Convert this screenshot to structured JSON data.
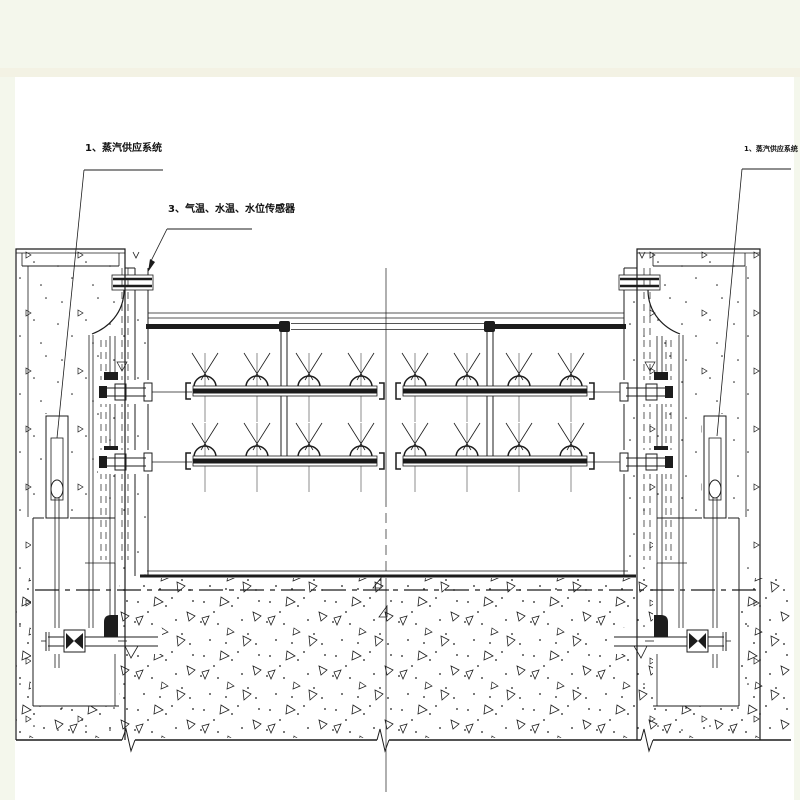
{
  "colors": {
    "outer_background": "#f4f7ec",
    "band_edge": "#f3f2e4",
    "paper": "#ffffff",
    "ink": "#1c1c1c"
  },
  "annotations": {
    "left_steam_label": "1、蒸汽供应系统",
    "sensor_label": "3、气温、水温、水位传感器",
    "right_steam_label": "1、蒸汽供应系统"
  },
  "figure": {
    "type": "engineering-section-drawing",
    "depicts": "water flume with steam spray manifolds between two concrete piers",
    "spray_manifold_rows": 2,
    "spray_manifold_groups": 2,
    "nozzles_per_manifold": 4
  }
}
